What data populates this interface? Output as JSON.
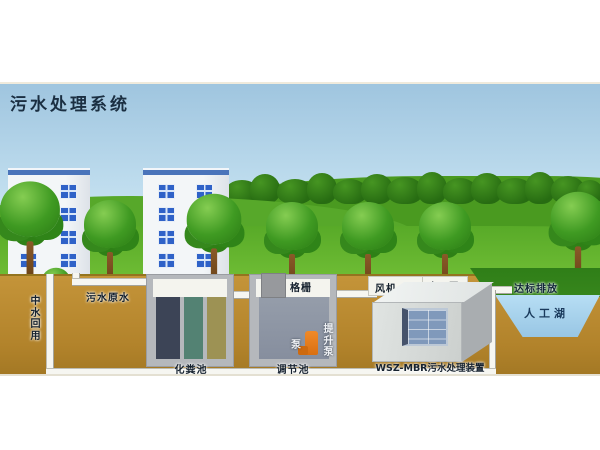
{
  "title": "污水处理系统",
  "labels": {
    "raw_sewage": "污水原水",
    "reclaimed_water_reuse": "中水回用",
    "septic_tank": "化粪池",
    "bar_screen": "格栅",
    "pump": "泵",
    "lift_pump": "提升泵",
    "regulating_tank": "调节池",
    "blower": "风机",
    "self_priming_pump": "自吸泵",
    "mbr_unit": "WSZ-MBR污水处理装置",
    "standard_discharge": "达标排放",
    "artificial_lake": "人工湖"
  },
  "colors": {
    "sky_top": "#9fc5df",
    "sky_bottom": "#e2f1f7",
    "hill_green": "#4a9a20",
    "grass_green": "#62b02c",
    "soil_brown": "#b2832b",
    "lake_blue": "#a8d2ec",
    "tank_wall_gray": "#b5b8bc",
    "septic_chamber_navy": "#3c4456",
    "septic_chamber_teal": "#538273",
    "septic_chamber_olive": "#9d9254",
    "regulating_water": "#8d95a5",
    "pump_orange": "#e2791c",
    "membrane_panel": "#8099bb",
    "building_window_blue": "#2f62c8",
    "pipe_white": "#f6f6f1",
    "label_text": "#16222f"
  }
}
